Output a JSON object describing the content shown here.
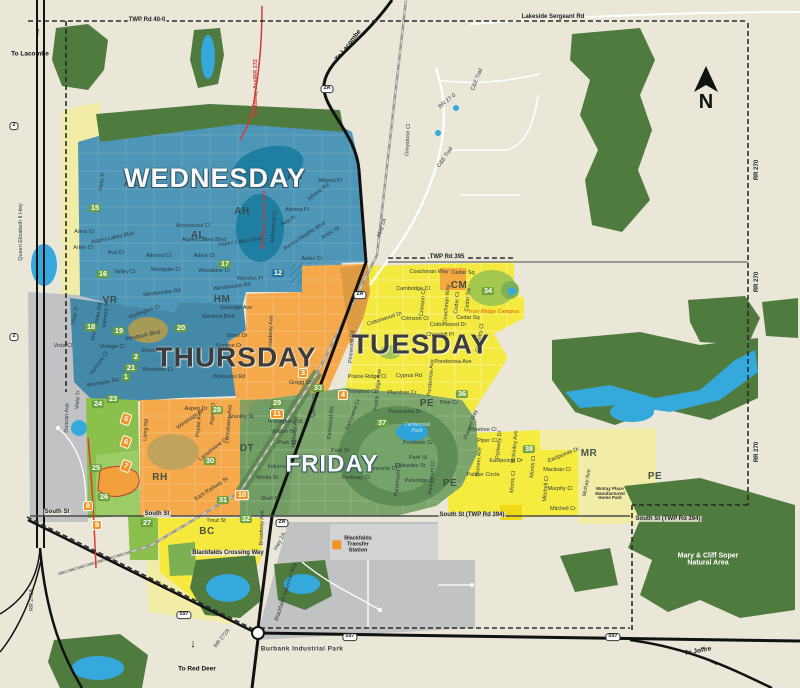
{
  "title": "Blackfalds collection day zones map",
  "compass": {
    "letter": "N"
  },
  "colors": {
    "background": "#EAE7D9",
    "wednesday_blue": "#4E96B8",
    "thursday_orange": "#F5A94B",
    "tuesday_yellow": "#F3E93F",
    "friday_green": "#7CA56C",
    "pale_yellow": "#F1ECA6",
    "forest_green": "#4F7B3E",
    "water_blue": "#35A8DC",
    "industrial_gray": "#C1C2C4",
    "highway_black": "#111111",
    "boundary_dash": "#2B2B2B",
    "broadway_red": "#D93A35",
    "badge_green": "#689E3A",
    "badge_orange": "#F29423"
  },
  "day_zones": [
    {
      "label": "WEDNESDAY",
      "x": 215,
      "y": 178,
      "size": 27,
      "theme": "light"
    },
    {
      "label": "THURSDAY",
      "x": 236,
      "y": 357,
      "size": 28,
      "theme": "dark"
    },
    {
      "label": "TUESDAY",
      "x": 421,
      "y": 344,
      "size": 28,
      "theme": "dark"
    },
    {
      "label": "FRIDAY",
      "x": 332,
      "y": 464,
      "size": 24,
      "theme": "light"
    }
  ],
  "district_codes": [
    [
      "AH",
      295,
      177
    ],
    [
      "AH",
      242,
      212
    ],
    [
      "AL",
      131,
      184
    ],
    [
      "AL",
      198,
      236
    ],
    [
      "VR",
      110,
      301
    ],
    [
      "HM",
      222,
      300
    ],
    [
      "CM",
      459,
      286
    ],
    [
      "PE",
      427,
      404
    ],
    [
      "PE",
      450,
      484
    ],
    [
      "PE",
      655,
      477
    ],
    [
      "DT",
      247,
      449
    ],
    [
      "RH",
      160,
      478
    ],
    [
      "BC",
      207,
      532
    ],
    [
      "MR",
      589,
      454
    ]
  ],
  "zone_numbers": [
    [
      "15",
      95,
      208,
      "g"
    ],
    [
      "16",
      103,
      274,
      "g"
    ],
    [
      "17",
      225,
      264,
      "g"
    ],
    [
      "18",
      91,
      327,
      "g"
    ],
    [
      "19",
      119,
      331,
      "g"
    ],
    [
      "20",
      181,
      328,
      "g"
    ],
    [
      "2",
      136,
      357,
      "g"
    ],
    [
      "21",
      131,
      368,
      "g"
    ],
    [
      "1",
      126,
      377,
      "g"
    ],
    [
      "12",
      278,
      273,
      "b"
    ],
    [
      "23",
      113,
      399,
      "g"
    ],
    [
      "24",
      98,
      404,
      "g"
    ],
    [
      "25",
      96,
      468,
      "g"
    ],
    [
      "26",
      104,
      497,
      "g"
    ],
    [
      "27",
      147,
      523,
      "g"
    ],
    [
      "28",
      217,
      410,
      "g"
    ],
    [
      "29",
      277,
      403,
      "g"
    ],
    [
      "30",
      210,
      461,
      "g"
    ],
    [
      "31",
      223,
      500,
      "g"
    ],
    [
      "32",
      246,
      519,
      "g"
    ],
    [
      "33",
      318,
      388,
      "g"
    ],
    [
      "34",
      488,
      291,
      "g"
    ],
    [
      "36",
      462,
      394,
      "g"
    ],
    [
      "37",
      382,
      423,
      "g"
    ],
    [
      "38",
      529,
      449,
      "g"
    ],
    [
      "3",
      303,
      373,
      "o"
    ],
    [
      "4",
      343,
      395,
      "o"
    ],
    [
      "5",
      126,
      419,
      "d"
    ],
    [
      "6",
      126,
      442,
      "d"
    ],
    [
      "7",
      126,
      466,
      "d"
    ],
    [
      "8",
      88,
      506,
      "o"
    ],
    [
      "9",
      97,
      525,
      "o"
    ],
    [
      "10",
      242,
      495,
      "o"
    ],
    [
      "11",
      277,
      414,
      "o"
    ]
  ],
  "shields": [
    [
      "2",
      14,
      126
    ],
    [
      "2",
      14,
      337
    ],
    [
      "2A",
      327,
      89
    ],
    [
      "2A",
      360,
      295
    ],
    [
      "2A",
      282,
      523
    ],
    [
      "597",
      184,
      615
    ],
    [
      "597",
      350,
      637
    ],
    [
      "597",
      613,
      637
    ]
  ],
  "streets": [
    [
      "TWP Rd 40-0",
      147,
      20,
      0,
      "h"
    ],
    [
      "Lakeside Sergeant Rd",
      553,
      17,
      0,
      "h"
    ],
    [
      "Queen Elizabeth II Hwy",
      22,
      232,
      -90,
      "s"
    ],
    [
      "RR 270",
      757,
      170,
      -90,
      "h"
    ],
    [
      "RR 270",
      757,
      282,
      -90,
      "h"
    ],
    [
      "RR 270",
      757,
      452,
      -90,
      "h"
    ],
    [
      "RR 272A",
      33,
      600,
      -90,
      "s"
    ],
    [
      "RR 272A",
      223,
      639,
      -52,
      "s"
    ],
    [
      "Broadway Ave/RR 272",
      257,
      88,
      -90,
      "r"
    ],
    [
      "Broadway Avenue 272",
      265,
      220,
      -88,
      "r"
    ],
    [
      "C&E Trail",
      478,
      80,
      -68,
      "s"
    ],
    [
      "C&E Trail",
      446,
      158,
      -55,
      "s"
    ],
    [
      "RR 27-0",
      448,
      102,
      -40,
      "s"
    ],
    [
      "Greystone Cl",
      409,
      140,
      -87,
      "s"
    ],
    [
      "TWP Rd 395",
      447,
      257,
      0,
      "h"
    ],
    [
      "Hwy 2A",
      383,
      228,
      -72,
      "s"
    ],
    [
      "Hwy 2A",
      281,
      542,
      -62,
      "s"
    ],
    [
      "Vista Tr",
      103,
      182,
      -80,
      "s"
    ],
    [
      "Anna Cl",
      84,
      233,
      0,
      "s"
    ],
    [
      "Aspen Lakes Blvd",
      113,
      239,
      -12,
      "s"
    ],
    [
      "Arlen Cl",
      83,
      249,
      0,
      "s"
    ],
    [
      "Ava Cr",
      116,
      254,
      0,
      "s"
    ],
    [
      "Arrowwood Cl",
      193,
      227,
      0,
      "s"
    ],
    [
      "Aspen Lakes Blvd",
      204,
      241,
      0,
      "s"
    ],
    [
      "Aspen Lakes Blvd",
      240,
      243,
      -8,
      "s"
    ],
    [
      "Almond Cr",
      159,
      257,
      0,
      "s"
    ],
    [
      "Adina Cl",
      204,
      257,
      0,
      "s"
    ],
    [
      "Athena Pl",
      330,
      182,
      0,
      "s"
    ],
    [
      "Athens Rd",
      319,
      193,
      -38,
      "s"
    ],
    [
      "Athena Pl",
      297,
      211,
      0,
      "s"
    ],
    [
      "Alderwood Cl",
      275,
      227,
      -85,
      "s"
    ],
    [
      "Ava Pl",
      289,
      222,
      -30,
      "s"
    ],
    [
      "Aurora Heights Blvd",
      305,
      237,
      -33,
      "s"
    ],
    [
      "Aztec St",
      331,
      234,
      -30,
      "s"
    ],
    [
      "Aztec Cr",
      312,
      260,
      0,
      "s"
    ],
    [
      "Valley Cr",
      125,
      273,
      0,
      "s"
    ],
    [
      "Westgate Cr",
      166,
      271,
      0,
      "s"
    ],
    [
      "Woodbine Cl",
      214,
      272,
      0,
      "s"
    ],
    [
      "Winston Pl",
      250,
      280,
      0,
      "s"
    ],
    [
      "Westbrooke Rd",
      232,
      288,
      -7,
      "s"
    ],
    [
      "Westbrooke Rd",
      162,
      294,
      -7,
      "s"
    ],
    [
      "Westbrooke Rd",
      98,
      322,
      -78,
      "s"
    ],
    [
      "Valmont St",
      107,
      315,
      -83,
      "s"
    ],
    [
      "Vista Tr",
      76,
      316,
      -78,
      "s"
    ],
    [
      "Vista Cl",
      63,
      347,
      0,
      "s"
    ],
    [
      "Vintage Cl",
      112,
      348,
      0,
      "s"
    ],
    [
      "Vermont Cl",
      100,
      364,
      -55,
      "s"
    ],
    [
      "Womacks Rd",
      103,
      384,
      -10,
      "s"
    ],
    [
      "Womacks Rd",
      229,
      378,
      0,
      "s"
    ],
    [
      "Wellington Cr",
      145,
      313,
      -20,
      "s"
    ],
    [
      "Westpark Blvd",
      143,
      337,
      -12,
      "s"
    ],
    [
      "Westview Cr",
      157,
      352,
      0,
      "s"
    ],
    [
      "Westview Cr",
      158,
      371,
      0,
      "s"
    ],
    [
      "Sunridge Ave",
      236,
      309,
      0,
      "s"
    ],
    [
      "Stanford Blvd",
      218,
      318,
      0,
      "s"
    ],
    [
      "Silver Dr",
      237,
      337,
      0,
      "s"
    ],
    [
      "Sunrise Cr",
      229,
      347,
      0,
      "s"
    ],
    [
      "Broadway Ave",
      272,
      333,
      -88,
      "s"
    ],
    [
      "Gregg St",
      300,
      384,
      0,
      "s"
    ],
    [
      "Stanley St",
      241,
      418,
      0,
      "s"
    ],
    [
      "Aspen Dr",
      196,
      410,
      0,
      "s"
    ],
    [
      "Poplar Ave",
      200,
      424,
      -85,
      "s"
    ],
    [
      "Aspen Cl",
      214,
      414,
      -85,
      "s"
    ],
    [
      "Westridge Dr",
      191,
      420,
      -35,
      "s"
    ],
    [
      "Lansdowne Ave",
      230,
      424,
      -85,
      "s"
    ],
    [
      "Lansdowne Dr",
      214,
      450,
      -38,
      "s"
    ],
    [
      "Laing Rd",
      147,
      430,
      -85,
      "s"
    ],
    [
      "East Railway St",
      212,
      490,
      -33,
      "s"
    ],
    [
      "Trout St",
      216,
      522,
      0,
      "s"
    ],
    [
      "South St",
      57,
      512,
      0,
      "h"
    ],
    [
      "South St",
      157,
      514,
      0,
      "h"
    ],
    [
      "South St (TWP Rd 394)",
      472,
      515,
      0,
      "h"
    ],
    [
      "South St (TWP Rd 394)",
      668,
      519,
      0,
      "h"
    ],
    [
      "Waghorn St",
      288,
      423,
      0,
      "s"
    ],
    [
      "Wilson St",
      283,
      433,
      0,
      "s"
    ],
    [
      "East Ave",
      273,
      412,
      -85,
      "s"
    ],
    [
      "Highway Ave",
      296,
      432,
      -85,
      "s"
    ],
    [
      "Queen Cl",
      315,
      406,
      -85,
      "s"
    ],
    [
      "Park St",
      287,
      444,
      0,
      "s"
    ],
    [
      "Indiana St",
      280,
      468,
      0,
      "s"
    ],
    [
      "Winks St",
      267,
      479,
      0,
      "s"
    ],
    [
      "Shull St",
      270,
      500,
      0,
      "s"
    ],
    [
      "Broadway Ave",
      263,
      528,
      -88,
      "s"
    ],
    [
      "Blackfalds Crossing Way",
      228,
      553,
      0,
      "h"
    ],
    [
      "Blackfalds Industrial Way",
      287,
      592,
      -72,
      "s"
    ],
    [
      "Coachman Way",
      429,
      273,
      0,
      "s"
    ],
    [
      "Cedar Sq",
      463,
      274,
      0,
      "s"
    ],
    [
      "Cambridge Cl",
      413,
      290,
      0,
      "s"
    ],
    [
      "Crimson Cl",
      424,
      303,
      -85,
      "s"
    ],
    [
      "Coachman Way",
      448,
      304,
      -85,
      "s"
    ],
    [
      "Cedar Cl",
      458,
      303,
      -85,
      "s"
    ],
    [
      "Cedar Sq",
      469,
      300,
      -85,
      "s"
    ],
    [
      "Crimson Ct",
      415,
      320,
      0,
      "s"
    ],
    [
      "Cottonwood Dr",
      385,
      320,
      -18,
      "s"
    ],
    [
      "Cottonwood Dr",
      448,
      326,
      0,
      "s"
    ],
    [
      "Churchill Pl",
      440,
      336,
      0,
      "s"
    ],
    [
      "Cedar Sq",
      468,
      319,
      0,
      "s"
    ],
    [
      "Coventry Cl",
      481,
      338,
      -80,
      "s"
    ],
    [
      "Ponderosa Ave",
      453,
      363,
      0,
      "s"
    ],
    [
      "Ponderosa Ave",
      432,
      378,
      -85,
      "s"
    ],
    [
      "Cyprus Rd",
      409,
      377,
      0,
      "s"
    ],
    [
      "Prairie Ridge Cl",
      367,
      378,
      0,
      "s"
    ],
    [
      "Pinewood Rd",
      353,
      347,
      -85,
      "s"
    ],
    [
      "Pinewood Cl",
      361,
      393,
      0,
      "s"
    ],
    [
      "Prairie Ridge Ave",
      379,
      390,
      -85,
      "s"
    ],
    [
      "Plumtree Cr",
      402,
      394,
      0,
      "s"
    ],
    [
      "Pine Cr",
      449,
      404,
      0,
      "s"
    ],
    [
      "Pinetree Cl",
      483,
      431,
      0,
      "s"
    ],
    [
      "Pioneer Way",
      472,
      425,
      -70,
      "s"
    ],
    [
      "Piper Cl",
      487,
      442,
      0,
      "s"
    ],
    [
      "Parkway Dr",
      500,
      445,
      -85,
      "s"
    ],
    [
      "Pioneer Ave",
      480,
      462,
      -85,
      "s"
    ],
    [
      "McKinley Ave",
      516,
      447,
      -85,
      "s"
    ],
    [
      "Eastpointe Dr",
      506,
      462,
      0,
      "s"
    ],
    [
      "Eastpointe Dr",
      564,
      456,
      -22,
      "s"
    ],
    [
      "Palmer Circle",
      483,
      476,
      0,
      "s"
    ],
    [
      "Morris Cl",
      514,
      482,
      -85,
      "s"
    ],
    [
      "Morris Cl",
      534,
      467,
      -85,
      "s"
    ],
    [
      "Maclean Cl",
      557,
      471,
      0,
      "s"
    ],
    [
      "Mitchell Cl",
      547,
      489,
      -85,
      "s"
    ],
    [
      "Murphy Cl",
      560,
      490,
      0,
      "s"
    ],
    [
      "Mitchell Cr",
      563,
      510,
      0,
      "s"
    ],
    [
      "McKay Ave",
      588,
      483,
      -80,
      "s"
    ],
    [
      "Panorama Dr",
      405,
      413,
      0,
      "s"
    ],
    [
      "Panorama Cr",
      354,
      415,
      -70,
      "s"
    ],
    [
      "Parkwood Rd",
      332,
      423,
      -85,
      "s"
    ],
    [
      "Park St",
      340,
      452,
      0,
      "s"
    ],
    [
      "Park St",
      418,
      459,
      0,
      "s"
    ],
    [
      "Pondside Cr",
      418,
      444,
      0,
      "s"
    ],
    [
      "Pinnacle Cl",
      383,
      470,
      0,
      "s"
    ],
    [
      "Parkway Cl",
      356,
      479,
      0,
      "s"
    ],
    [
      "Palisades St",
      410,
      467,
      0,
      "s"
    ],
    [
      "Paramount Cl",
      399,
      480,
      -85,
      "s"
    ],
    [
      "Parkridge Cr",
      420,
      482,
      0,
      "s"
    ],
    [
      "Parkmount Cl",
      433,
      478,
      -85,
      "s"
    ],
    [
      "Duncan Ave",
      68,
      418,
      -88,
      "s"
    ],
    [
      "Vista Tr",
      79,
      400,
      -85,
      "s"
    ]
  ],
  "pois": [
    {
      "text": "Centennial\nPark",
      "x": 417,
      "y": 429,
      "cls": "park"
    },
    {
      "text": "Mary & Cliff Soper\nNatural Area",
      "x": 708,
      "y": 560,
      "cls": "nature"
    },
    {
      "text": "McKay Place\nManufactured\nHome Park",
      "x": 610,
      "y": 494,
      "cls": "tinypoi"
    },
    {
      "text": "Burbank Industrial Park",
      "x": 302,
      "y": 650,
      "cls": "ind"
    },
    {
      "text": "Iron Ridge Campus",
      "x": 494,
      "y": 313,
      "cls": "school"
    }
  ],
  "transfer_station": {
    "label": "Blackfalds\nTransfer\nStation",
    "x": 352,
    "y": 545
  },
  "directions": [
    {
      "text": "To Lacombe",
      "x": 30,
      "y": 55,
      "rot": 0
    },
    {
      "text": "To Lacombe",
      "x": 349,
      "y": 46,
      "rot": -52
    },
    {
      "text": "To Red Deer",
      "x": 197,
      "y": 670,
      "rot": 0
    },
    {
      "text": "To Joffre",
      "x": 698,
      "y": 652,
      "rot": -10
    }
  ],
  "direction_arrows": [
    {
      "glyph": "↑",
      "x": 38,
      "y": 33,
      "rot": 0
    },
    {
      "glyph": "↑",
      "x": 362,
      "y": 36,
      "rot": 42
    },
    {
      "glyph": "↓",
      "x": 193,
      "y": 645,
      "rot": 0
    },
    {
      "glyph": "→",
      "x": 714,
      "y": 663,
      "rot": 18
    }
  ]
}
